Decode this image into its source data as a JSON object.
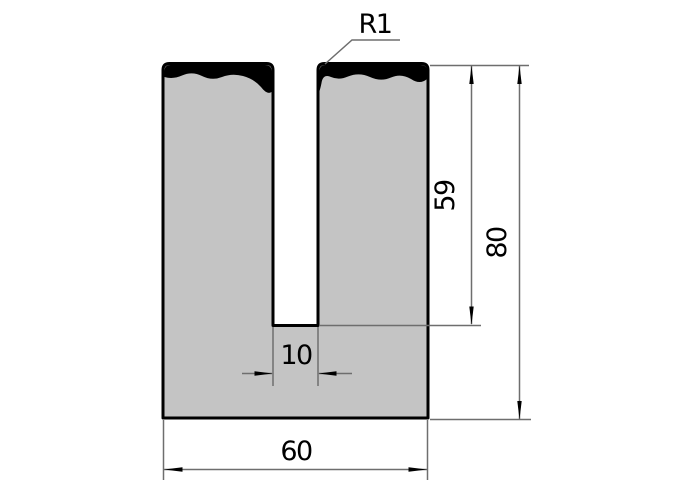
{
  "drawing": {
    "labels": {
      "radius": "R1",
      "slot_depth": "59",
      "total_height": "80",
      "slot_width": "10",
      "total_width": "60"
    },
    "colors": {
      "background": "#ffffff",
      "part_fill": "#c4c4c4",
      "outline": "#000000",
      "hardened_zone": "#000000",
      "dimension_lines": "#6e6e6e",
      "text": "#000000"
    }
  }
}
